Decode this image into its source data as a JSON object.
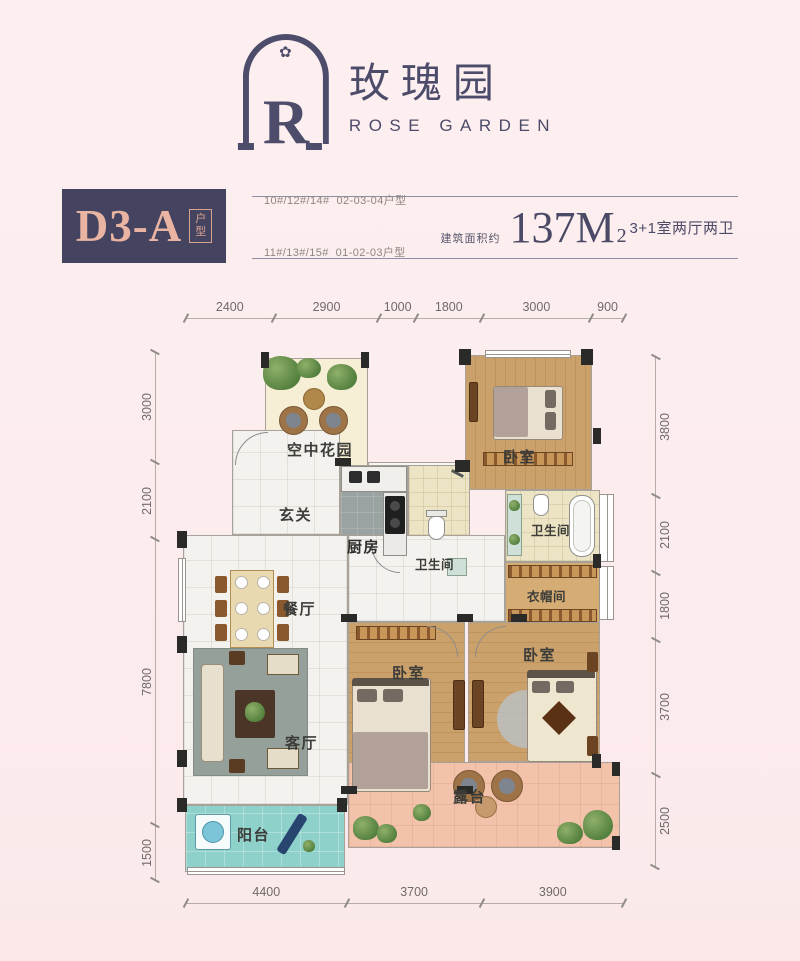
{
  "logo": {
    "letter": "R",
    "flourish": "✿",
    "name_cn": "玫瑰园",
    "name_en": "ROSE GARDEN"
  },
  "title_block": {
    "unit_code": "D3-A",
    "unit_tag": "户型",
    "building_lines": [
      "10#/12#/14#  02-03-04户型",
      "11#/13#/15#  01-02-03户型"
    ],
    "area_label": "建筑面积约",
    "area_value": "137M",
    "area_exp": "2",
    "layout_desc": "3+1室两厅两卫"
  },
  "rooms": {
    "sky_garden": "空中花园",
    "hallway": "玄关",
    "kitchen": "厨房",
    "bath_a": "卫生间",
    "bath_b": "卫生间",
    "bedroom_a": "卧室",
    "bedroom_b": "卧室",
    "bedroom_c": "卧室",
    "cloakroom": "衣帽间",
    "dining": "餐厅",
    "living": "客厅",
    "terrace": "露台",
    "balcony": "阳台"
  },
  "dims": {
    "top": [
      "2400",
      "2900",
      "1000",
      "1800",
      "3000",
      "900"
    ],
    "left": [
      "3000",
      "2100",
      "7800",
      "1500"
    ],
    "right": [
      "3800",
      "2100",
      "1800",
      "3700",
      "2500"
    ],
    "bottom": [
      "4400",
      "3700",
      "3900"
    ]
  },
  "colors": {
    "navy": "#454460",
    "salmon": "#eab4a3",
    "background": "#fcecee",
    "wood": "#c99f66",
    "terrace": "#f2c2ab",
    "balcony": "#8ed0ca"
  }
}
